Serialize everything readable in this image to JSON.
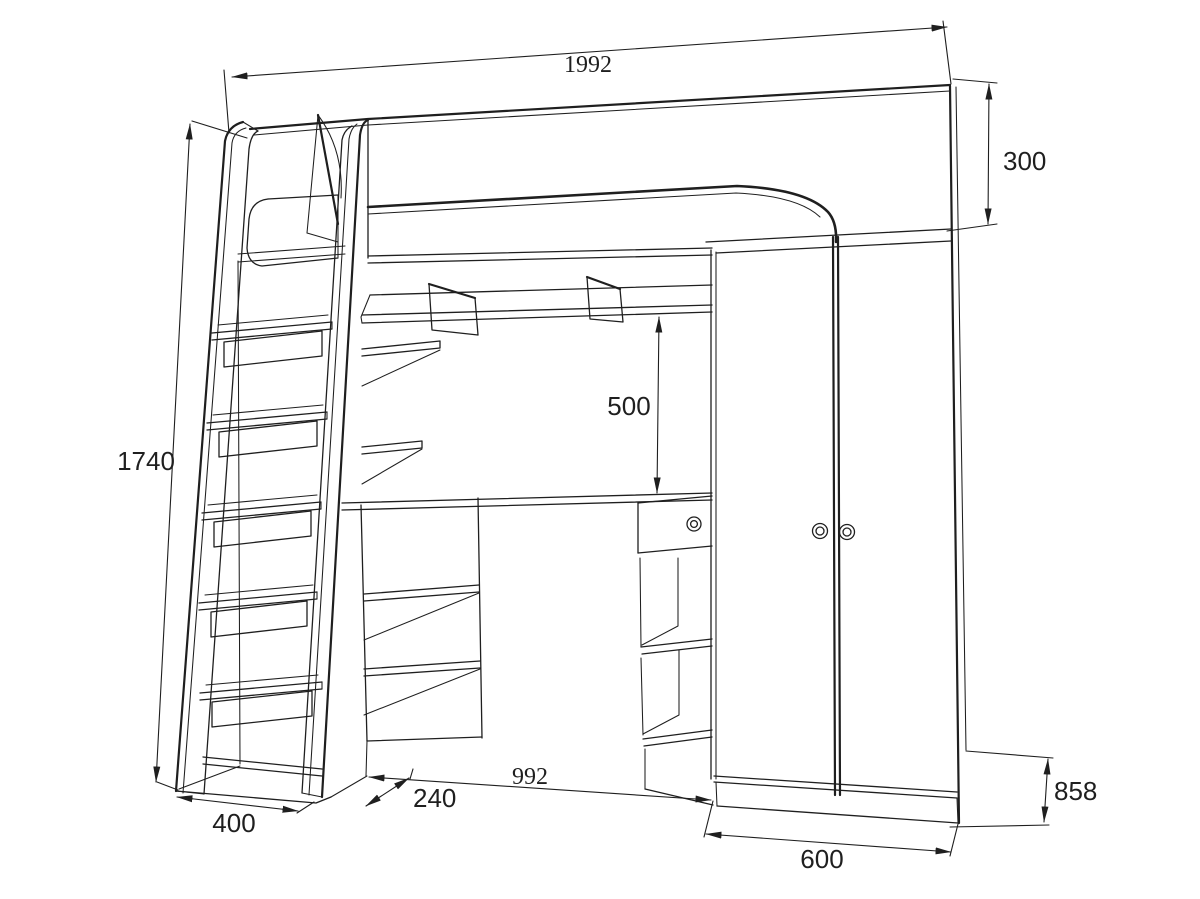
{
  "meta": {
    "title": "Loft bed dimensional drawing",
    "units": "mm",
    "style": {
      "line_color": "#1f1f1f",
      "background": "#ffffff"
    }
  },
  "dimensions": {
    "overall_width": "1992",
    "back_panel_height": "300",
    "overall_height": "1740",
    "shelf_to_desk_height": "500",
    "desk_section_width": "992",
    "ladder_footprint_width": "400",
    "ladder_offset_depth": "240",
    "wardrobe_width": "600",
    "side_depth": "858"
  }
}
